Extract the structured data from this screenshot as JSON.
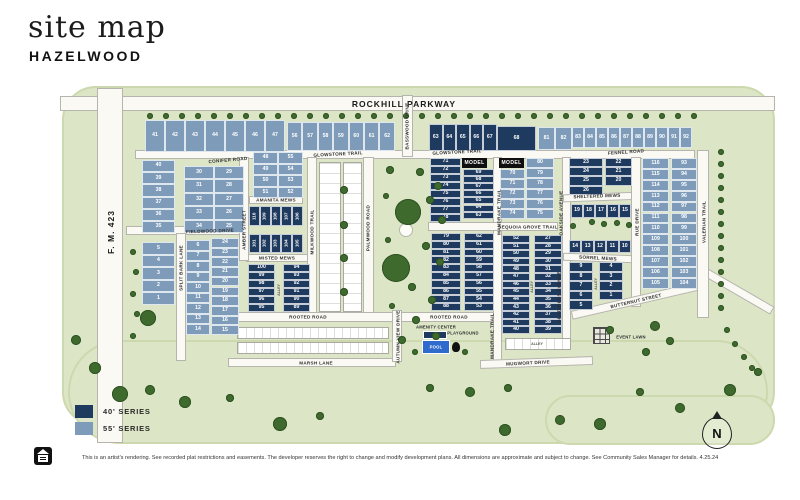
{
  "title": {
    "main": "site map",
    "sub": "HAZELWOOD"
  },
  "legend": {
    "items": [
      {
        "label": "40' SERIES",
        "color": "#1e3a5e"
      },
      {
        "label": "55' SERIES",
        "color": "#7e9cba"
      }
    ]
  },
  "footer": {
    "disclaimer": "This is an artist's rendering. See recorded plat restrictions and easements. The developer reserves the right to change and modify development plans. All dimensions are approximate and subject to change. See Community Sales Manager for details. 4.25.24"
  },
  "map": {
    "north_label": "N",
    "model_label": "MODEL",
    "alley_label": "ALLEY",
    "colors": {
      "series40": "#1e3a5e",
      "series55": "#7e9cba",
      "map_green": "#dce6c6",
      "road": "#faf9f4",
      "tree": "#3f6a2e",
      "pool": "#2e6bcc",
      "model_bg": "#0f0f0f"
    },
    "street_labels": [
      {
        "text": "ROCKHILL PARKWAY",
        "x": 404,
        "y": 104,
        "r": 0,
        "major": true
      },
      {
        "text": "F. M. 423",
        "x": 111,
        "y": 232,
        "r": -90,
        "major": true
      },
      {
        "text": "CONIFER ROAD",
        "x": 228,
        "y": 160,
        "r": -5
      },
      {
        "text": "GLOWSTONE TRAIL",
        "x": 338,
        "y": 154,
        "r": -3
      },
      {
        "text": "GLOWSTONE TRAIL",
        "x": 457,
        "y": 152,
        "r": -3
      },
      {
        "text": "FENNEL ROAD",
        "x": 626,
        "y": 152,
        "r": -4
      },
      {
        "text": "AMANITA MEWS",
        "x": 276,
        "y": 200,
        "r": 0
      },
      {
        "text": "FIELDWOOD DRIVE",
        "x": 210,
        "y": 231,
        "r": -2
      },
      {
        "text": "MISTED MEWS",
        "x": 277,
        "y": 258,
        "r": 0
      },
      {
        "text": "SPLIT BARK LANE",
        "x": 181,
        "y": 268,
        "r": -90
      },
      {
        "text": "AMBER STREET",
        "x": 244,
        "y": 230,
        "r": -90
      },
      {
        "text": "MILKWOOD TRAIL",
        "x": 312,
        "y": 232,
        "r": -90
      },
      {
        "text": "PALMWOOD ROAD",
        "x": 368,
        "y": 228,
        "r": -90
      },
      {
        "text": "BASSWOOD DRIVE",
        "x": 407,
        "y": 126,
        "r": -90
      },
      {
        "text": "ROOTED ROAD",
        "x": 308,
        "y": 317,
        "r": 0
      },
      {
        "text": "ROOTED ROAD",
        "x": 449,
        "y": 317,
        "r": 0
      },
      {
        "text": "MARSH LANE",
        "x": 316,
        "y": 363,
        "r": 0
      },
      {
        "text": "AUTUMN VIEW DRIVE",
        "x": 398,
        "y": 337,
        "r": -90
      },
      {
        "text": "MANDRAKE TRAIL",
        "x": 499,
        "y": 212,
        "r": -90
      },
      {
        "text": "MANDRAKE TRAIL",
        "x": 492,
        "y": 336,
        "r": -90
      },
      {
        "text": "SEQUOIA GROVE TRAIL",
        "x": 528,
        "y": 227,
        "r": 0
      },
      {
        "text": "MUGWORT DRIVE",
        "x": 528,
        "y": 363,
        "r": -3
      },
      {
        "text": "OAKSIDE AVENUE",
        "x": 561,
        "y": 213,
        "r": -90
      },
      {
        "text": "GLADIOLUS AVENUE",
        "x": 559,
        "y": 297,
        "r": -90
      },
      {
        "text": "SHELTERED MEWS",
        "x": 597,
        "y": 196,
        "r": -2
      },
      {
        "text": "SORREL MEWS",
        "x": 598,
        "y": 258,
        "r": 3
      },
      {
        "text": "BUTTERNUT STREET",
        "x": 636,
        "y": 301,
        "r": -13
      },
      {
        "text": "RUE DRIVE",
        "x": 637,
        "y": 222,
        "r": -90
      },
      {
        "text": "VALERIAN TRAIL",
        "x": 704,
        "y": 222,
        "r": -90
      }
    ],
    "amenity_labels": [
      {
        "text": "AMENITY CENTER",
        "x": 436,
        "y": 327
      },
      {
        "text": "PLAYGROUND",
        "x": 463,
        "y": 333
      },
      {
        "text": "EVENT LAWN",
        "x": 631,
        "y": 337
      },
      {
        "text": "POOL",
        "x": 436,
        "y": 347,
        "white": true
      }
    ],
    "alleys": [
      {
        "x": 279,
        "y": 290,
        "r": -90
      },
      {
        "x": 532,
        "y": 287,
        "r": -90
      },
      {
        "x": 596,
        "y": 284,
        "r": -90
      },
      {
        "x": 537,
        "y": 344,
        "r": 0
      }
    ],
    "models": [
      {
        "x": 462,
        "y": 158
      },
      {
        "x": 499,
        "y": 158
      }
    ],
    "lot_groups": [
      {
        "id": "row-41-47",
        "series": "55",
        "type": "row",
        "x": 145,
        "y": 120,
        "h": 32,
        "lw": 20,
        "nums": [
          "41",
          "42",
          "43",
          "44",
          "45",
          "46",
          "47"
        ]
      },
      {
        "id": "row-56-62",
        "series": "55",
        "type": "row",
        "x": 287,
        "y": 122,
        "h": 29,
        "lw": 15.4,
        "nums": [
          "56",
          "57",
          "58",
          "59",
          "60",
          "61",
          "62"
        ]
      },
      {
        "id": "row-63-67",
        "series": "40",
        "type": "row",
        "x": 429,
        "y": 124,
        "h": 27,
        "lw": 13.5,
        "nums": [
          "63",
          "64",
          "65",
          "66",
          "67"
        ]
      },
      {
        "id": "lot-68",
        "series": "40",
        "type": "row",
        "x": 497,
        "y": 126,
        "h": 25,
        "lw": 39,
        "nums": [
          "68"
        ]
      },
      {
        "id": "row-81-82",
        "series": "55",
        "type": "row",
        "x": 538,
        "y": 127,
        "h": 23,
        "lw": 17,
        "nums": [
          "81",
          "82"
        ]
      },
      {
        "id": "row-83-92",
        "series": "55",
        "type": "row",
        "x": 572,
        "y": 127,
        "h": 21,
        "lw": 12,
        "nums": [
          "83",
          "84",
          "85",
          "86",
          "87",
          "88",
          "89",
          "90",
          "91",
          "92"
        ]
      },
      {
        "id": "col-40-35",
        "series": "55",
        "type": "col",
        "x": 142,
        "y": 160,
        "w": 33,
        "lh": 12.2,
        "nums": [
          "40",
          "39",
          "38",
          "37",
          "36",
          "35"
        ]
      },
      {
        "id": "col-5-1",
        "series": "55",
        "type": "col",
        "x": 142,
        "y": 242,
        "w": 33,
        "lh": 12.6,
        "nums": [
          "5",
          "4",
          "3",
          "2",
          "1"
        ]
      },
      {
        "id": "col-30-34",
        "series": "55",
        "type": "col",
        "x": 184,
        "y": 166,
        "w": 30,
        "lh": 13.4,
        "nums": [
          "30",
          "31",
          "32",
          "33",
          "34"
        ]
      },
      {
        "id": "col-29-25",
        "series": "55",
        "type": "col",
        "x": 214,
        "y": 166,
        "w": 30,
        "lh": 13.4,
        "nums": [
          "29",
          "28",
          "27",
          "26",
          "25"
        ]
      },
      {
        "id": "col-48-51",
        "series": "55",
        "type": "col",
        "x": 253,
        "y": 152,
        "w": 25,
        "lh": 11.5,
        "nums": [
          "48",
          "49",
          "50",
          "51"
        ]
      },
      {
        "id": "col-55-52",
        "series": "55",
        "type": "col",
        "x": 278,
        "y": 152,
        "w": 25,
        "lh": 11.5,
        "nums": [
          "55",
          "54",
          "53",
          "52"
        ]
      },
      {
        "id": "col-6-14",
        "series": "55",
        "type": "col",
        "x": 186,
        "y": 240,
        "w": 24,
        "lh": 10.5,
        "nums": [
          "6",
          "7",
          "8",
          "9",
          "10",
          "11",
          "12",
          "13",
          "14"
        ]
      },
      {
        "id": "col-24-15",
        "series": "55",
        "type": "col",
        "x": 211,
        "y": 238,
        "w": 28,
        "lh": 9.7,
        "nums": [
          "24",
          "23",
          "22",
          "21",
          "20",
          "19",
          "18",
          "17",
          "16",
          "15"
        ]
      },
      {
        "id": "vrow-110-106",
        "series": "40",
        "type": "vrow",
        "x": 249,
        "y": 206,
        "h": 20,
        "lw": 10.8,
        "nums": [
          "110",
          "109",
          "108",
          "107",
          "106"
        ]
      },
      {
        "id": "vrow-101-105",
        "series": "40",
        "type": "vrow",
        "x": 249,
        "y": 234,
        "h": 19,
        "lw": 10.8,
        "nums": [
          "101",
          "102",
          "103",
          "104",
          "105"
        ]
      },
      {
        "id": "col-100-95",
        "series": "40",
        "type": "col",
        "x": 248,
        "y": 264,
        "w": 27,
        "lh": 8,
        "nums": [
          "100",
          "99",
          "98",
          "97",
          "96",
          "95"
        ]
      },
      {
        "id": "col-94-89",
        "series": "40",
        "type": "col",
        "x": 283,
        "y": 264,
        "w": 27,
        "lh": 8,
        "nums": [
          "94",
          "93",
          "92",
          "91",
          "90",
          "89"
        ]
      },
      {
        "id": "col-71-78",
        "series": "40",
        "type": "col",
        "x": 430,
        "y": 158,
        "w": 31,
        "lh": 8,
        "nums": [
          "71",
          "72",
          "73",
          "74",
          "75",
          "76",
          "77",
          "78"
        ]
      },
      {
        "id": "col-69-63",
        "series": "40",
        "type": "col",
        "x": 463,
        "y": 169,
        "w": 31,
        "lh": 7.1,
        "nums": [
          "69",
          "68",
          "67",
          "66",
          "65",
          "64",
          "63"
        ]
      },
      {
        "id": "col-70-74",
        "series": "55",
        "type": "col",
        "x": 500,
        "y": 169,
        "w": 25,
        "lh": 10,
        "nums": [
          "70",
          "71",
          "72",
          "73",
          "74"
        ]
      },
      {
        "id": "col-80-75",
        "series": "55",
        "type": "col",
        "x": 526,
        "y": 158,
        "w": 28,
        "lh": 10.2,
        "nums": [
          "80",
          "79",
          "78",
          "77",
          "76",
          "75"
        ]
      },
      {
        "id": "col-79-88",
        "series": "40",
        "type": "col",
        "x": 431,
        "y": 233,
        "w": 30,
        "lh": 7.8,
        "nums": [
          "79",
          "80",
          "81",
          "82",
          "83",
          "84",
          "85",
          "86",
          "87",
          "88"
        ]
      },
      {
        "id": "col-62-53",
        "series": "40",
        "type": "col",
        "x": 464,
        "y": 233,
        "w": 30,
        "lh": 7.8,
        "nums": [
          "62",
          "61",
          "60",
          "59",
          "58",
          "57",
          "56",
          "55",
          "54",
          "53"
        ]
      },
      {
        "id": "col-52-40",
        "series": "40",
        "type": "col",
        "x": 502,
        "y": 235,
        "w": 28,
        "lh": 7.6,
        "nums": [
          "52",
          "51",
          "50",
          "49",
          "48",
          "47",
          "46",
          "45",
          "44",
          "43",
          "42",
          "41",
          "40"
        ]
      },
      {
        "id": "col-27-39",
        "series": "40",
        "type": "col",
        "x": 534,
        "y": 235,
        "w": 28,
        "lh": 7.6,
        "nums": [
          "27",
          "28",
          "29",
          "30",
          "31",
          "32",
          "33",
          "34",
          "35",
          "36",
          "37",
          "38",
          "39"
        ]
      },
      {
        "id": "col-23-26",
        "series": "40",
        "type": "col",
        "x": 569,
        "y": 158,
        "w": 34,
        "lh": 9.2,
        "nums": [
          "23",
          "24",
          "25",
          "26"
        ]
      },
      {
        "id": "col-22-20",
        "series": "40",
        "type": "col",
        "x": 605,
        "y": 158,
        "w": 27,
        "lh": 9.2,
        "nums": [
          "22",
          "21",
          "20"
        ]
      },
      {
        "id": "row-19-15",
        "series": "40",
        "type": "row",
        "x": 571,
        "y": 204,
        "h": 14,
        "lw": 12,
        "nums": [
          "19",
          "18",
          "17",
          "16",
          "15"
        ]
      },
      {
        "id": "row-14-10",
        "series": "40",
        "type": "row",
        "x": 569,
        "y": 240,
        "h": 13,
        "lw": 12.4,
        "nums": [
          "14",
          "13",
          "12",
          "11",
          "10"
        ]
      },
      {
        "id": "col-9-5",
        "series": "40",
        "type": "col",
        "x": 569,
        "y": 262,
        "w": 24,
        "lh": 9.6,
        "nums": [
          "9",
          "8",
          "7",
          "6",
          "5"
        ]
      },
      {
        "id": "col-4-1",
        "series": "40",
        "type": "col",
        "x": 599,
        "y": 262,
        "w": 24,
        "lh": 9.6,
        "nums": [
          "4",
          "3",
          "2",
          "1"
        ]
      },
      {
        "id": "col-116-105",
        "series": "55",
        "type": "col",
        "x": 642,
        "y": 158,
        "w": 27,
        "lh": 10.9,
        "nums": [
          "116",
          "115",
          "114",
          "113",
          "112",
          "111",
          "110",
          "109",
          "108",
          "107",
          "106",
          "105"
        ]
      },
      {
        "id": "col-93-104",
        "series": "55",
        "type": "col",
        "x": 671,
        "y": 158,
        "w": 26,
        "lh": 10.9,
        "nums": [
          "93",
          "94",
          "95",
          "96",
          "97",
          "98",
          "99",
          "100",
          "101",
          "102",
          "103",
          "104"
        ]
      }
    ]
  }
}
